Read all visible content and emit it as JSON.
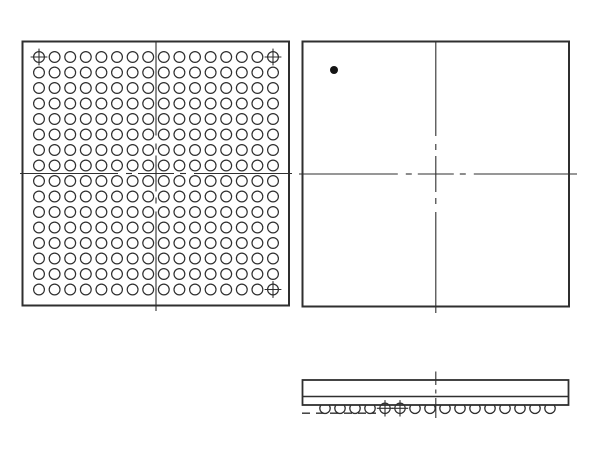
{
  "drawing": {
    "type": "bga-package-outline",
    "background": "#ffffff",
    "stroke_color": "#2f2f2f",
    "dot_fill": "#141414",
    "views": {
      "bottom_view": {
        "outline": {
          "x": 22.5,
          "y": 41.5,
          "width": 266.5,
          "height": 264,
          "stroke_width": 2
        },
        "ball_grid": {
          "rows": 16,
          "cols": 16,
          "first_x": 39,
          "first_y": 57,
          "pitch_x": 15.6,
          "pitch_y": 15.5,
          "ball_radius": 5.4,
          "stroke_width": 1.2
        },
        "fiducial_balls": [
          {
            "row": 0,
            "col": 0
          },
          {
            "row": 0,
            "col": 15
          },
          {
            "row": 15,
            "col": 15
          }
        ],
        "centerlines": {
          "vertical": {
            "x": 156,
            "from": 41.5,
            "to": 311,
            "cross": 173.5
          },
          "horizontal": {
            "y": 173.5,
            "from": 20,
            "to": 292,
            "cross": 156
          }
        }
      },
      "top_view": {
        "outline": {
          "x": 302.5,
          "y": 41.5,
          "width": 266.5,
          "height": 265,
          "stroke_width": 2
        },
        "pin1_dot": {
          "cx": 334,
          "cy": 70,
          "r": 4
        },
        "centerlines": {
          "vertical": {
            "x": 435.8,
            "from": 41.5,
            "to": 313,
            "cross": 174
          },
          "horizontal": {
            "y": 174,
            "from": 299,
            "to": 577,
            "cross": 435.8
          }
        }
      },
      "side_view": {
        "body": {
          "x": 302.5,
          "y": 380,
          "width": 266,
          "height": 25,
          "stroke_width": 1.8
        },
        "substrate_line_y": 396.5,
        "balls": {
          "count": 16,
          "first_x": 325,
          "pitch": 15,
          "cy": 408.3,
          "r": 5.2,
          "crosshair_indices": [
            4,
            5
          ]
        },
        "seating_plane_dashes": {
          "y": 413.2,
          "from": 302,
          "to": 376,
          "dash": "8 6"
        },
        "centerline": {
          "x": 435.8,
          "segments": [
            [
              371.5,
              385
            ],
            [
              389.5,
              393.5
            ],
            [
              398,
              418
            ]
          ]
        }
      }
    }
  }
}
